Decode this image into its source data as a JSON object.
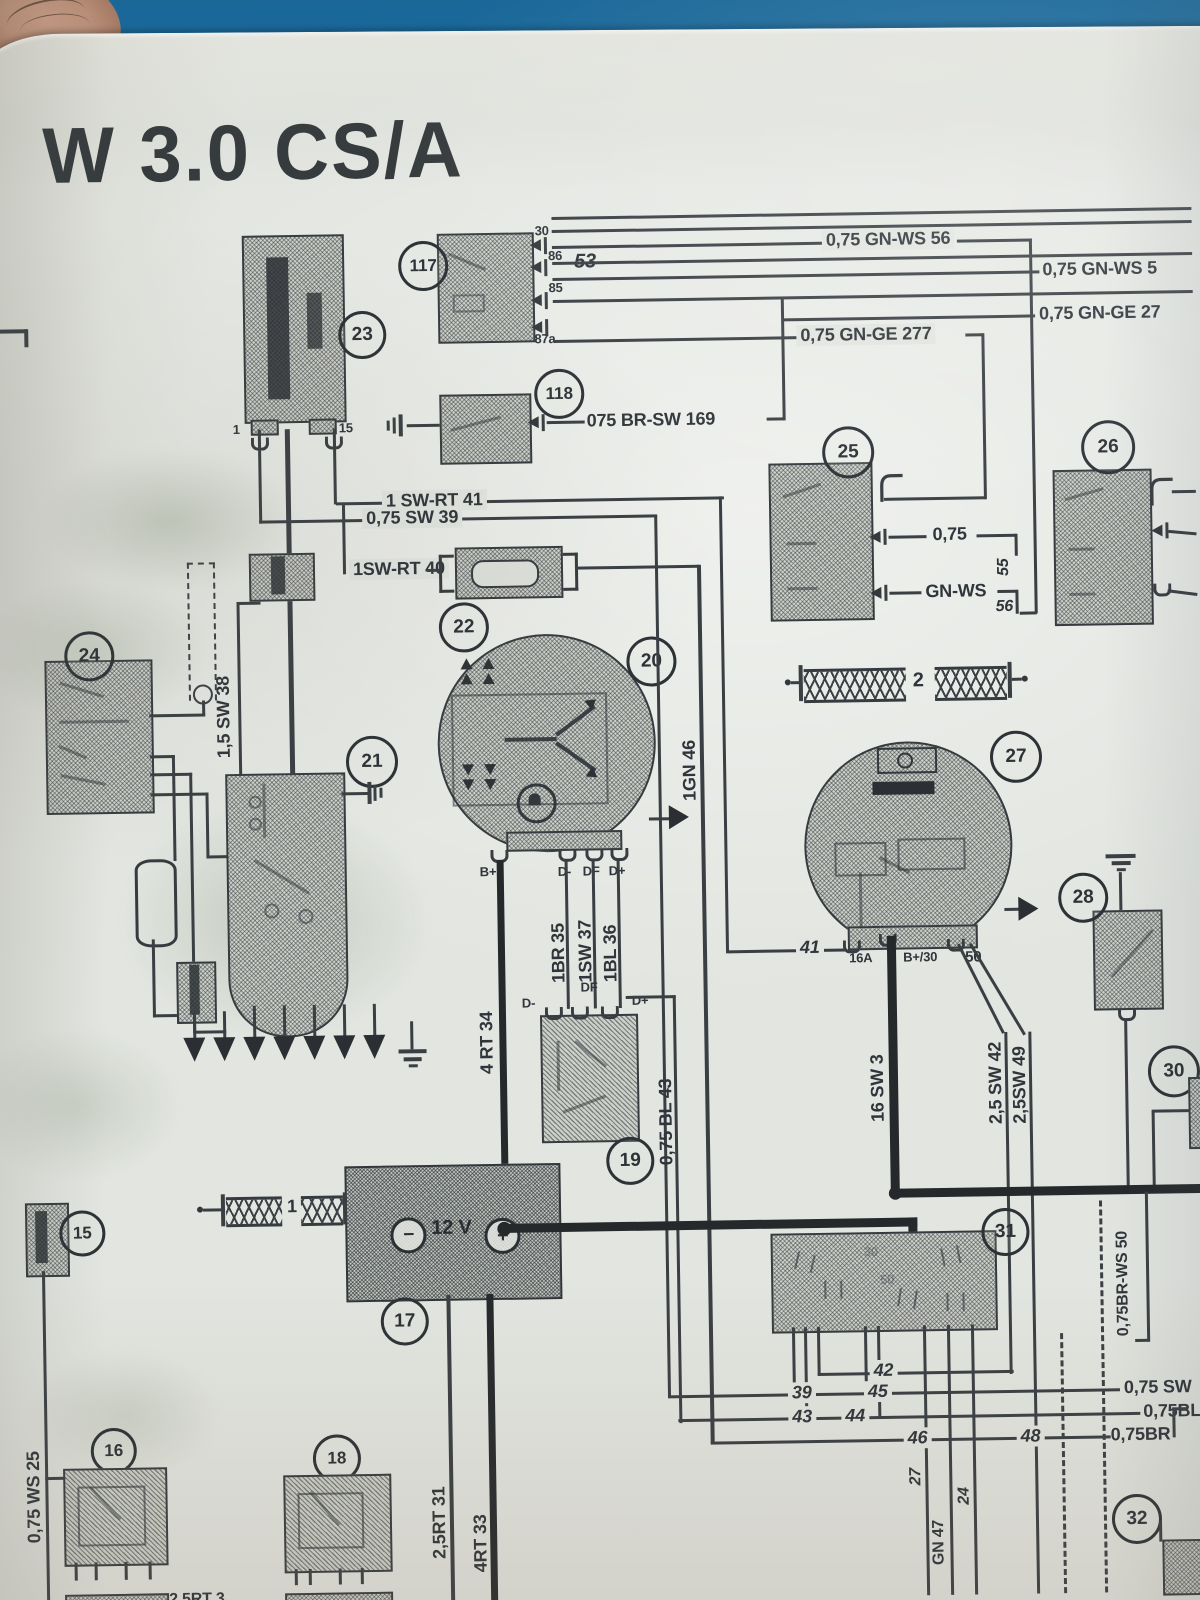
{
  "title": "W 3.0 CS/A",
  "colors": {
    "ink": "#33383c",
    "paper": "#e2e5e0",
    "table_blue": "#1f7fba",
    "skin": "#c79a84"
  },
  "comp": {
    "n15": "15",
    "n16": "16",
    "n17": "17",
    "n18": "18",
    "n19": "19",
    "n20": "20",
    "n21": "21",
    "n22": "22",
    "n23": "23",
    "n24": "24",
    "n25": "25",
    "n26": "26",
    "n27": "27",
    "n28": "28",
    "n30": "30",
    "n31": "31",
    "n32": "32",
    "n117": "117",
    "n118": "118"
  },
  "term": {
    "t1": "1",
    "t15": "15",
    "t30": "30",
    "t86": "86",
    "t85": "85",
    "t87a": "87a",
    "bp": "B+",
    "dm": "D-",
    "df": "DF",
    "dp": "D+",
    "t16a": "16A",
    "bp30": "B+/30",
    "t50": "50",
    "minus": "−",
    "plus": "+",
    "volts": "12 V",
    "f1": "1",
    "f2": "2",
    "f30": "30",
    "f50": "50"
  },
  "w": {
    "gnws56": "0,75 GN-WS 56",
    "gnws5": "0,75 GN-WS 5",
    "gnge27": "0,75 GN-GE 27",
    "gnge277": "0,75 GN-GE 277",
    "brsw169": "075 BR-SW 169",
    "n53": "53",
    "swrt41": "1 SW-RT 41",
    "sw39": "0,75 SW 39",
    "swrt40": "1SW-RT 40",
    "sw38": "1,5 SW 38",
    "q075": "0,75",
    "gnws": "GN-WS",
    "n55": "55",
    "n56": "56",
    "br35": "1BR 35",
    "sw37": "1SW 37",
    "bl36": "1BL 36",
    "gn46": "1GN 46",
    "rt34": "4 RT 34",
    "bl43": "0,75 BL 43",
    "n41": "41",
    "sw3": "16 SW 3",
    "sw42": "2,5 SW 42",
    "sw49": "2,5SW 49",
    "brws50": "0,75BR-WS 50",
    "ws25": "0,75 WS 25",
    "rt31": "2,5RT 31",
    "rt33": "4RT 33",
    "rt3": "2,5RT 3",
    "n39": "39",
    "n43": "43",
    "n44": "44",
    "n45": "45",
    "n42": "42",
    "n46": "46",
    "n48": "48",
    "sw075": "0,75 SW",
    "bl075": "0,75BL",
    "br075": "0,75BR",
    "n27": "27",
    "n24": "24",
    "gn47": "GN 47"
  }
}
